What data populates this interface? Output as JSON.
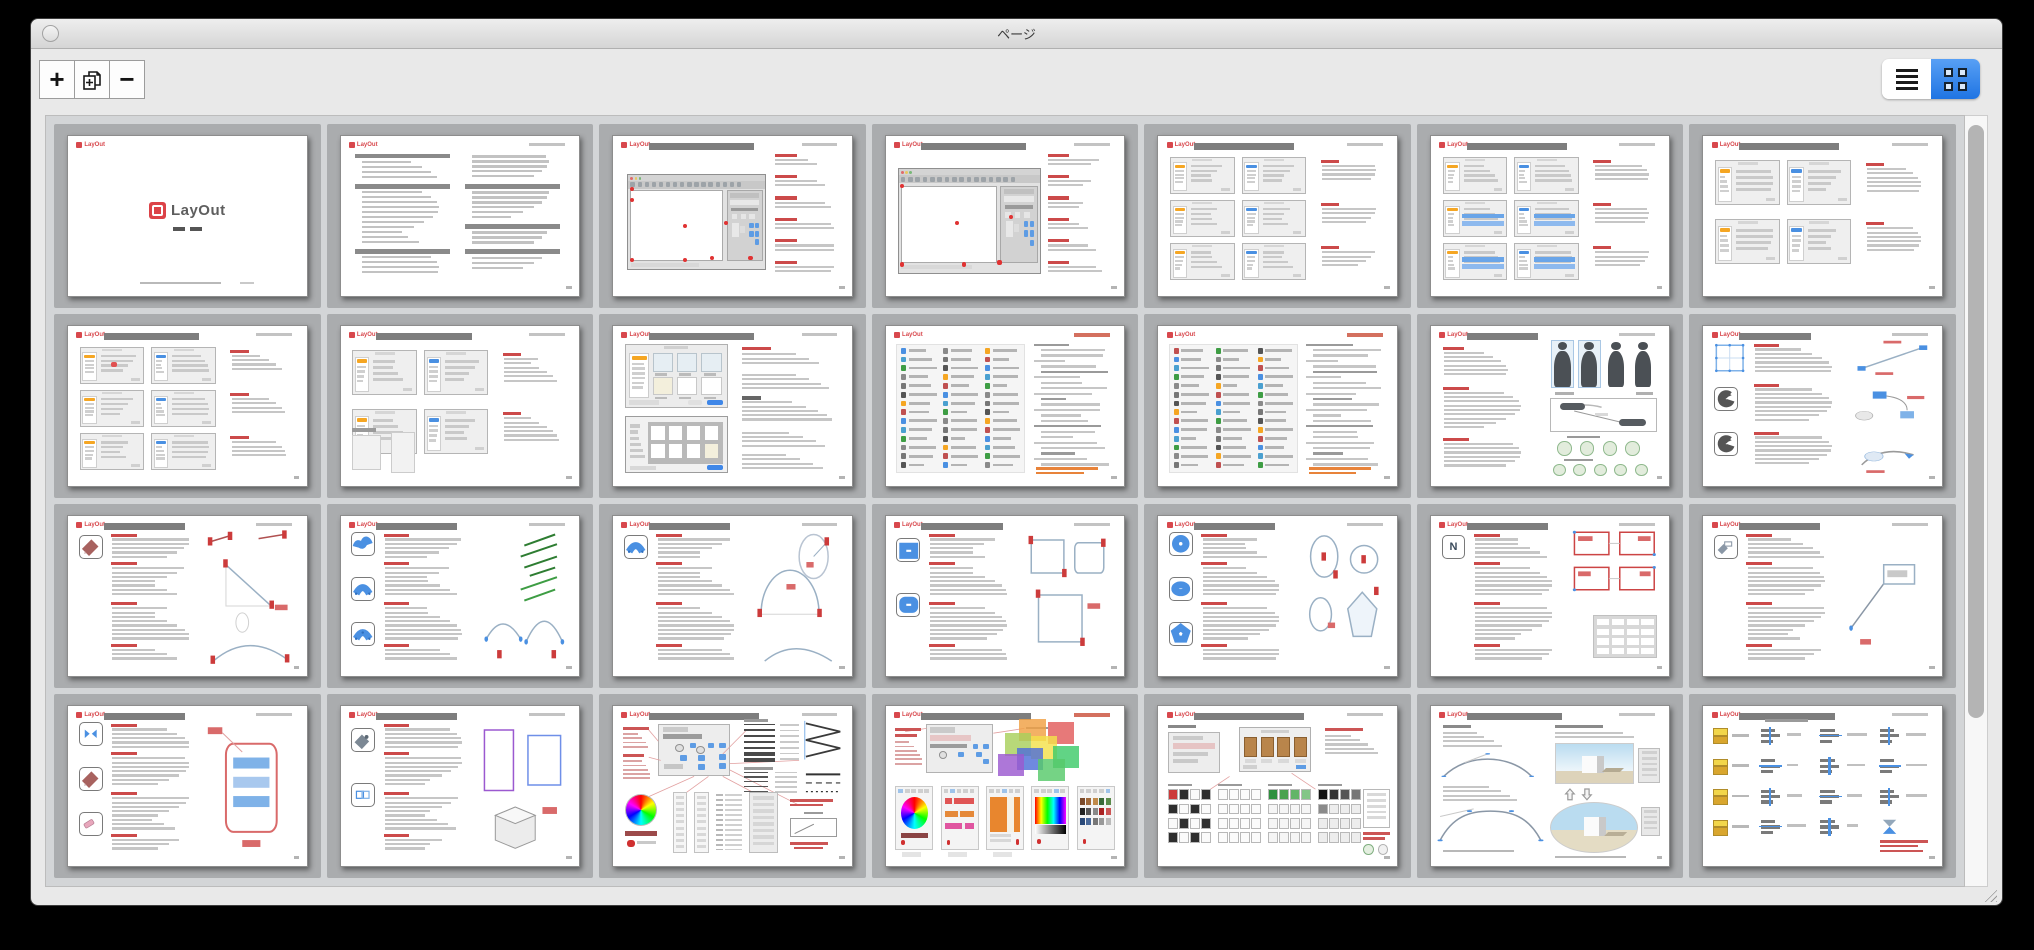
{
  "window": {
    "title": "ページ"
  },
  "logo": {
    "wordmark": "LayOut"
  },
  "toolbar": {
    "buttons": [
      {
        "name": "add-page",
        "icon": "plus"
      },
      {
        "name": "duplicate-page",
        "icon": "duplicate-page"
      },
      {
        "name": "delete-page",
        "icon": "minus"
      }
    ]
  },
  "view_toggle": {
    "modes": [
      {
        "name": "list",
        "icon": "list-icon",
        "active": false
      },
      {
        "name": "grid",
        "icon": "grid-icon",
        "active": true
      }
    ]
  },
  "colors": {
    "accent_blue": "#2f7de1",
    "logo_red": "#d8484d",
    "annotation_red": "#cc4a4a",
    "select_blue": "#4a90e2",
    "orange": "#f5a623",
    "green": "#3e9d44",
    "slot_gray": "#aaacae",
    "canvas_bg": "#d3d5d7",
    "silhouette": "#4b5055"
  },
  "pages": [
    {
      "n": 1,
      "variant": "title"
    },
    {
      "n": 2,
      "variant": "toc"
    },
    {
      "n": 3,
      "variant": "app",
      "bar_w": 44,
      "dots": 8
    },
    {
      "n": 4,
      "variant": "app",
      "bar_w": 44,
      "dots": 6,
      "big": true
    },
    {
      "n": 5,
      "variant": "dialogs",
      "bar_w": 42,
      "rows": 3
    },
    {
      "n": 6,
      "variant": "dialogs",
      "bar_w": 42,
      "rows": 3,
      "blue_bars": true
    },
    {
      "n": 7,
      "variant": "dialogs",
      "bar_w": 42,
      "rows": 2
    },
    {
      "n": 8,
      "variant": "dialogs",
      "bar_w": 40,
      "rows": 3,
      "annotated": true
    },
    {
      "n": 9,
      "variant": "dialogs",
      "bar_w": 40,
      "rows": 2,
      "extras": true
    },
    {
      "n": 10,
      "variant": "templates",
      "bar_w": 44
    },
    {
      "n": 11,
      "variant": "toolbarlist",
      "tr": "red"
    },
    {
      "n": 12,
      "variant": "toolbarlist",
      "tr": "red",
      "seed": 5
    },
    {
      "n": 13,
      "variant": "people",
      "bar_w": 30
    },
    {
      "n": 14,
      "variant": "transform",
      "bar_w": 30
    },
    {
      "n": 15,
      "variant": "tool",
      "bar_w": 34,
      "icons": [
        "pencil"
      ],
      "diagram": "lines"
    },
    {
      "n": 16,
      "variant": "tool",
      "bar_w": 34,
      "icons": [
        "freehand",
        "arc2",
        "arc3"
      ],
      "diagram": "green"
    },
    {
      "n": 17,
      "variant": "tool",
      "bar_w": 34,
      "icons": [
        "arc2"
      ],
      "diagram": "arcs"
    },
    {
      "n": 18,
      "variant": "tool",
      "bar_w": 34,
      "icons": [
        "rect",
        "rrect"
      ],
      "diagram": "rects"
    },
    {
      "n": 19,
      "variant": "tool",
      "bar_w": 34,
      "icons": [
        "circle",
        "ellipse",
        "polygon"
      ],
      "diagram": "circles"
    },
    {
      "n": 20,
      "variant": "tool",
      "bar_w": 34,
      "icons": [
        "text"
      ],
      "icon_text": "N",
      "diagram": "textboxes"
    },
    {
      "n": 21,
      "variant": "tool",
      "bar_w": 34,
      "icons": [
        "label"
      ],
      "diagram": "label"
    },
    {
      "n": 22,
      "variant": "tool",
      "bar_w": 34,
      "icons": [
        "split",
        "pencil",
        "eraser"
      ],
      "diagram": "redbox"
    },
    {
      "n": 23,
      "variant": "tool",
      "bar_w": 34,
      "icons": [
        "dropper",
        "join"
      ],
      "diagram": "cubes"
    },
    {
      "n": 24,
      "variant": "stylepanel",
      "bar_w": 46
    },
    {
      "n": 25,
      "variant": "colorpickers",
      "bar_w": 46,
      "tr": "red"
    },
    {
      "n": 26,
      "variant": "swatches",
      "bar_w": 46
    },
    {
      "n": 27,
      "variant": "curves",
      "bar_w": 40
    },
    {
      "n": 28,
      "variant": "align",
      "bar_w": 40
    }
  ]
}
